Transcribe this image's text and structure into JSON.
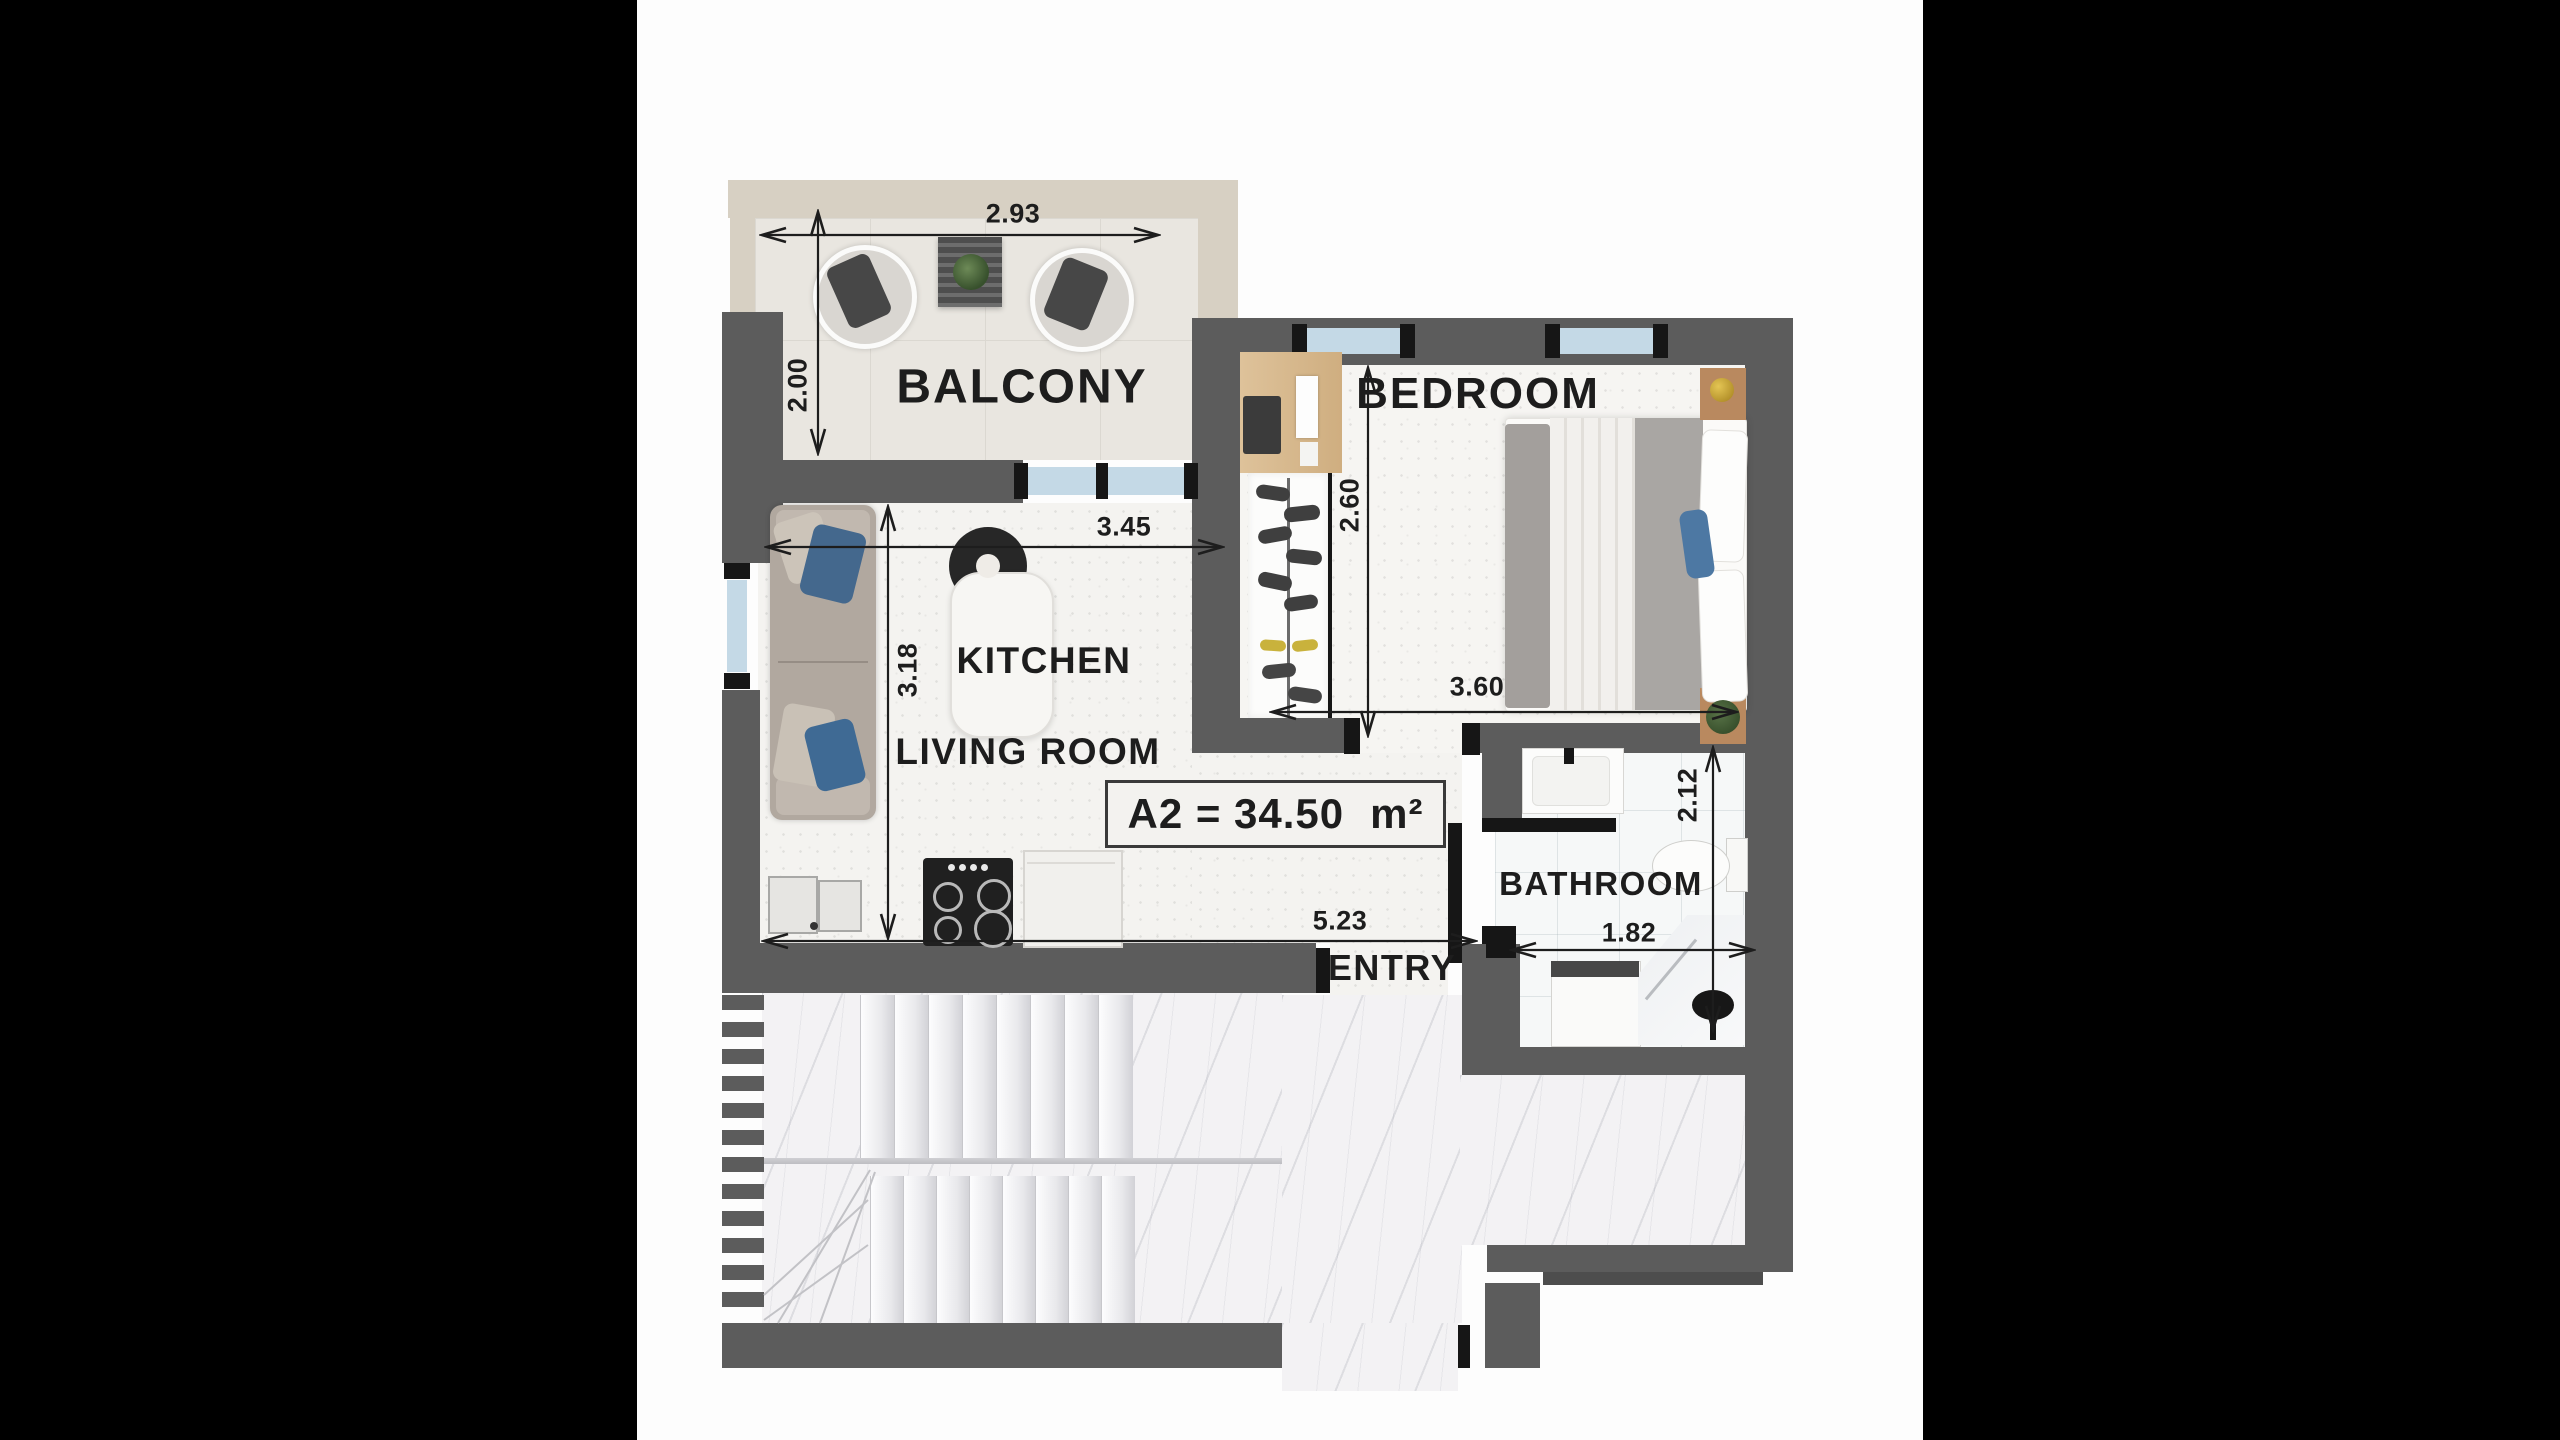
{
  "plan": {
    "area": {
      "label": "A2 = 34.50",
      "unit": "m²"
    },
    "rooms": {
      "balcony": "BALCONY",
      "bedroom": "BEDROOM",
      "kitchen": "KITCHEN",
      "living_room": "LIVING ROOM",
      "bathroom": "BATHROOM",
      "entry": "ENTRY"
    },
    "dimensions_m": {
      "balcony_width": "2.93",
      "balcony_depth": "2.00",
      "living_width": "3.45",
      "living_depth": "3.18",
      "bedroom_depth": "2.60",
      "bedroom_width": "3.60",
      "bathroom_depth": "2.12",
      "bathroom_width": "1.82",
      "entry_wall_span": "5.23"
    },
    "colors": {
      "wall": "#5c5c5c",
      "balcony_parapet": "#d7d0c3",
      "window_glass": "#c4d9e6",
      "pillow_blue": "#44688d",
      "text": "#1d1d1d"
    }
  }
}
